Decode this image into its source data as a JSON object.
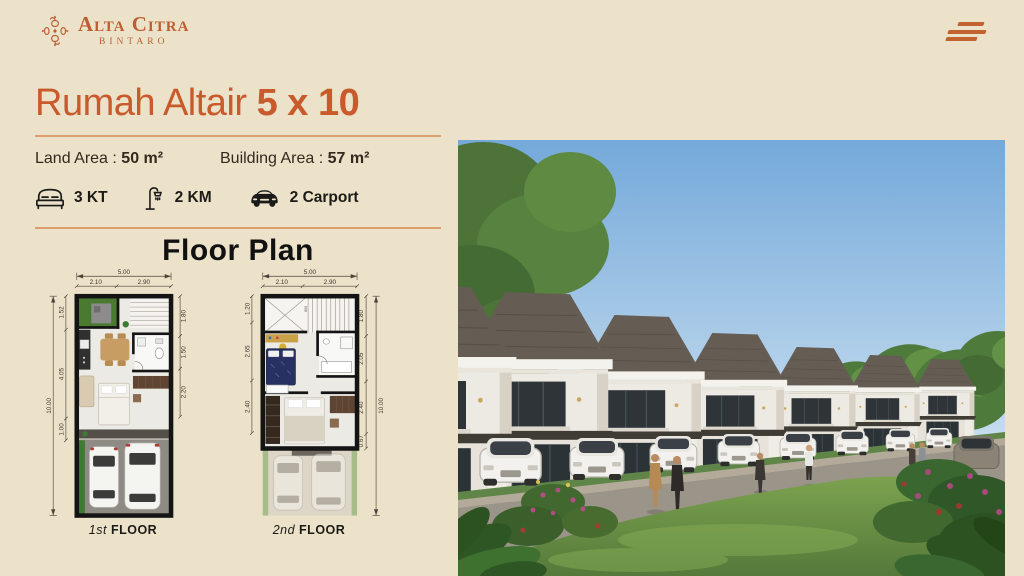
{
  "theme": {
    "background": "#ece2c9",
    "accent": "#c85a2b",
    "divider": "#dd9e6e",
    "text_dark": "#30281d",
    "plan_wall": "#141414"
  },
  "header": {
    "brand_name": "Alta Citra",
    "brand_location": "BINTARO",
    "ornament_icon": "floral-knot-icon",
    "menu_icon": "hamburger-menu-icon"
  },
  "listing": {
    "title_name": "Rumah Altair",
    "title_size": "5 x 10",
    "land_area_label": "Land Area :",
    "land_area_value": "50 m²",
    "building_area_label": "Building Area :",
    "building_area_value": "57 m²",
    "features": [
      {
        "icon": "bed-icon",
        "label": "3 KT"
      },
      {
        "icon": "shower-icon",
        "label": "2 KM"
      },
      {
        "icon": "car-icon",
        "label": "2 Carport"
      }
    ]
  },
  "floor_plan": {
    "heading": "Floor Plan",
    "plans": [
      {
        "caption_prefix": "1st",
        "caption_suffix": "FLOOR",
        "dim_width_total": "5.00",
        "dim_width_left": "2.10",
        "dim_width_right": "2.90",
        "dim_height_total": "10.00",
        "dim_left_segments": [
          "1.52",
          "4.05",
          "1.00"
        ],
        "dim_right_segments": [
          "1.80",
          "1.50",
          "2.20"
        ]
      },
      {
        "caption_prefix": "2nd",
        "caption_suffix": "FLOOR",
        "dim_width_total": "5.00",
        "dim_width_left": "2.10",
        "dim_width_right": "2.90",
        "dim_height_total": "10.00",
        "dim_left_segments": [
          "1.20",
          "2.65",
          "2.40"
        ],
        "dim_right_segments": [
          "1.80",
          "2.05",
          "2.40",
          "0.67"
        ],
        "stair_note": "800"
      }
    ]
  }
}
